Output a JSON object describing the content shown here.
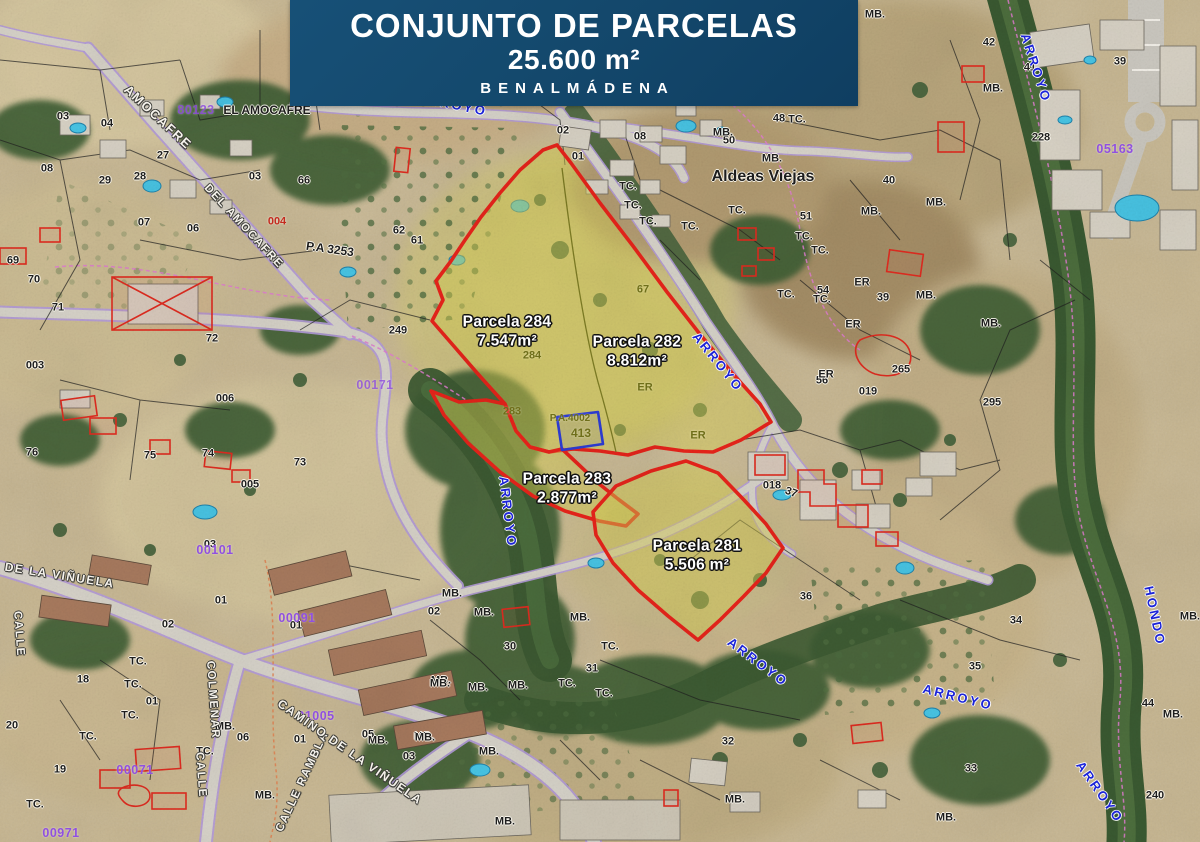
{
  "banner": {
    "title": "CONJUNTO DE PARCELAS",
    "area": "25.600 m²",
    "location": "BENALMÁDENA"
  },
  "colors": {
    "banner_bg": "#14496d",
    "parcel_stroke": "#e8231a",
    "parcel_fill": "rgba(214,204,84,0.48)",
    "blue_plot": "#2d3cd6",
    "stream_text": "#1b23d8",
    "cadastral_purple": "#9050e0",
    "road_purple": "#b49bdc",
    "water_pool": "#48c6e6",
    "vegetation_dark": "#3c5a32"
  },
  "map": {
    "parcels": [
      {
        "number": "284",
        "name": "Parcela 284",
        "area": "7.547m²",
        "label_x": 507,
        "label_y": 332
      },
      {
        "number": "282",
        "name": "Parcela 282",
        "area": "8.812m²",
        "label_x": 637,
        "label_y": 352
      },
      {
        "number": "283",
        "name": "Parcela 283",
        "area": "2.877m²",
        "label_x": 567,
        "label_y": 489
      },
      {
        "number": "281",
        "name": "Parcela 281",
        "area": "5.506 m²",
        "label_x": 697,
        "label_y": 556
      }
    ],
    "parcel_outlines": [
      {
        "id": "parcela-284-282",
        "points": "543,150 557,145 571,163 600,203 633,246 667,292 699,333 733,374 760,404 771,422 741,440 713,452 684,451 655,447 628,455 600,451 573,449 549,452 530,447 516,431 505,404 478,374 452,344 432,321 443,300 436,281 451,261 465,240 481,217 500,193 520,170"
      },
      {
        "id": "parcela-283",
        "points": "431,391 459,402 486,400 505,404 516,431 530,447 549,452 562,449 578,464 598,483 618,499 638,514 626,526 599,521 565,511 533,496 500,472 468,443 444,415"
      },
      {
        "id": "parcela-281",
        "points": "616,486 651,471 686,461 718,473 744,500 766,524 783,548 766,573 744,596 720,620 698,640 668,616 638,590 613,563 596,535 593,512"
      }
    ],
    "parcel_dividers": [
      "M562,168 C572,250 584,330 598,382 C606,410 612,434 616,452"
    ],
    "blue_plot": {
      "points": "557,417 598,412 603,444 562,450"
    },
    "labels": {
      "black": [
        {
          "t": "03",
          "x": 63,
          "y": 117
        },
        {
          "t": "04",
          "x": 107,
          "y": 124
        },
        {
          "t": "08",
          "x": 47,
          "y": 169
        },
        {
          "t": "27",
          "x": 163,
          "y": 156
        },
        {
          "t": "28",
          "x": 140,
          "y": 177
        },
        {
          "t": "29",
          "x": 105,
          "y": 181
        },
        {
          "t": "03",
          "x": 255,
          "y": 177
        },
        {
          "t": "66",
          "x": 304,
          "y": 181
        },
        {
          "t": "07",
          "x": 144,
          "y": 223
        },
        {
          "t": "06",
          "x": 193,
          "y": 229
        },
        {
          "t": "69",
          "x": 13,
          "y": 261
        },
        {
          "t": "70",
          "x": 34,
          "y": 280
        },
        {
          "t": "71",
          "x": 58,
          "y": 308
        },
        {
          "t": "72",
          "x": 212,
          "y": 339
        },
        {
          "t": "003",
          "x": 35,
          "y": 366
        },
        {
          "t": "006",
          "x": 225,
          "y": 399
        },
        {
          "t": "76",
          "x": 32,
          "y": 453
        },
        {
          "t": "75",
          "x": 150,
          "y": 456
        },
        {
          "t": "74",
          "x": 208,
          "y": 454
        },
        {
          "t": "73",
          "x": 300,
          "y": 463
        },
        {
          "t": "005",
          "x": 250,
          "y": 485
        },
        {
          "t": "249",
          "x": 398,
          "y": 331
        },
        {
          "t": "P.A 3253",
          "x": 330,
          "y": 249,
          "r": 8,
          "s": 12
        },
        {
          "t": "EL AMOCAFRE",
          "x": 267,
          "y": 110,
          "s": 12
        },
        {
          "t": "62",
          "x": 399,
          "y": 231
        },
        {
          "t": "61",
          "x": 417,
          "y": 241
        },
        {
          "t": "02",
          "x": 563,
          "y": 131
        },
        {
          "t": "01",
          "x": 578,
          "y": 157
        },
        {
          "t": "08",
          "x": 640,
          "y": 137
        },
        {
          "t": "48",
          "x": 779,
          "y": 119
        },
        {
          "t": "50",
          "x": 729,
          "y": 141
        },
        {
          "t": "40",
          "x": 889,
          "y": 181
        },
        {
          "t": "51",
          "x": 806,
          "y": 217
        },
        {
          "t": "Aldeas Viejas",
          "x": 763,
          "y": 177,
          "s": 16
        },
        {
          "t": "54",
          "x": 823,
          "y": 291
        },
        {
          "t": "39",
          "x": 883,
          "y": 298
        },
        {
          "t": "56",
          "x": 822,
          "y": 381
        },
        {
          "t": "295",
          "x": 992,
          "y": 403
        },
        {
          "t": "265",
          "x": 901,
          "y": 370
        },
        {
          "t": "019",
          "x": 868,
          "y": 392
        },
        {
          "t": "018",
          "x": 772,
          "y": 486
        },
        {
          "t": "37",
          "x": 791,
          "y": 493,
          "r": 20
        },
        {
          "t": "36",
          "x": 806,
          "y": 597
        },
        {
          "t": "42",
          "x": 989,
          "y": 43
        },
        {
          "t": "41",
          "x": 1030,
          "y": 68
        },
        {
          "t": "39",
          "x": 1120,
          "y": 62
        },
        {
          "t": "228",
          "x": 1041,
          "y": 138
        },
        {
          "t": "34",
          "x": 1016,
          "y": 621
        },
        {
          "t": "35",
          "x": 975,
          "y": 667
        },
        {
          "t": "33",
          "x": 971,
          "y": 769
        },
        {
          "t": "44",
          "x": 1148,
          "y": 704
        },
        {
          "t": "240",
          "x": 1155,
          "y": 796
        },
        {
          "t": "30",
          "x": 510,
          "y": 647
        },
        {
          "t": "31",
          "x": 592,
          "y": 669
        },
        {
          "t": "02",
          "x": 434,
          "y": 612
        },
        {
          "t": "03",
          "x": 409,
          "y": 757
        },
        {
          "t": "32",
          "x": 728,
          "y": 742
        },
        {
          "t": "03",
          "x": 210,
          "y": 545
        },
        {
          "t": "01",
          "x": 221,
          "y": 601
        },
        {
          "t": "02",
          "x": 168,
          "y": 625
        },
        {
          "t": "01",
          "x": 296,
          "y": 626
        },
        {
          "t": "18",
          "x": 83,
          "y": 680
        },
        {
          "t": "20",
          "x": 12,
          "y": 726
        },
        {
          "t": "19",
          "x": 60,
          "y": 770
        },
        {
          "t": "01",
          "x": 152,
          "y": 702
        },
        {
          "t": "05",
          "x": 368,
          "y": 735
        },
        {
          "t": "06",
          "x": 243,
          "y": 738
        },
        {
          "t": "01",
          "x": 300,
          "y": 740
        },
        {
          "t": "MB.",
          "x": 723,
          "y": 133
        },
        {
          "t": "MB.",
          "x": 772,
          "y": 159
        },
        {
          "t": "MB.",
          "x": 871,
          "y": 212
        },
        {
          "t": "MB.",
          "x": 936,
          "y": 203
        },
        {
          "t": "MB.",
          "x": 926,
          "y": 296
        },
        {
          "t": "MB.",
          "x": 991,
          "y": 324
        },
        {
          "t": "MB.",
          "x": 993,
          "y": 89
        },
        {
          "t": "MB.",
          "x": 875,
          "y": 15
        },
        {
          "t": "MB.",
          "x": 758,
          "y": 12
        },
        {
          "t": "MB.",
          "x": 1190,
          "y": 617
        },
        {
          "t": "MB.",
          "x": 1173,
          "y": 715
        },
        {
          "t": "MB.",
          "x": 946,
          "y": 818
        },
        {
          "t": "MB.",
          "x": 452,
          "y": 594
        },
        {
          "t": "MB.",
          "x": 484,
          "y": 613
        },
        {
          "t": "MB.",
          "x": 580,
          "y": 618
        },
        {
          "t": "MB.",
          "x": 441,
          "y": 681
        },
        {
          "t": "MB.",
          "x": 478,
          "y": 688
        },
        {
          "t": "MB.",
          "x": 518,
          "y": 686
        },
        {
          "t": "MB.",
          "x": 424,
          "y": 737
        },
        {
          "t": "MB.",
          "x": 489,
          "y": 752
        },
        {
          "t": "MB.",
          "x": 505,
          "y": 822
        },
        {
          "t": "MB.",
          "x": 225,
          "y": 727
        },
        {
          "t": "MB.",
          "x": 378,
          "y": 741
        },
        {
          "t": "MB.",
          "x": 425,
          "y": 738
        },
        {
          "t": "MB.",
          "x": 440,
          "y": 684
        },
        {
          "t": "MB.",
          "x": 265,
          "y": 796
        },
        {
          "t": "MB.",
          "x": 735,
          "y": 800
        },
        {
          "t": "TC.",
          "x": 797,
          "y": 120
        },
        {
          "t": "TC.",
          "x": 737,
          "y": 211
        },
        {
          "t": "TC.",
          "x": 628,
          "y": 187
        },
        {
          "t": "TC.",
          "x": 633,
          "y": 206
        },
        {
          "t": "TC.",
          "x": 648,
          "y": 222
        },
        {
          "t": "TC.",
          "x": 690,
          "y": 227
        },
        {
          "t": "TC.",
          "x": 804,
          "y": 237
        },
        {
          "t": "TC.",
          "x": 820,
          "y": 251
        },
        {
          "t": "TC.",
          "x": 786,
          "y": 295
        },
        {
          "t": "TC.",
          "x": 822,
          "y": 300
        },
        {
          "t": "TC.",
          "x": 610,
          "y": 647
        },
        {
          "t": "TC.",
          "x": 567,
          "y": 684
        },
        {
          "t": "TC.",
          "x": 604,
          "y": 694
        },
        {
          "t": "TC.",
          "x": 138,
          "y": 662
        },
        {
          "t": "TC.",
          "x": 133,
          "y": 685
        },
        {
          "t": "TC.",
          "x": 130,
          "y": 716
        },
        {
          "t": "TC.",
          "x": 35,
          "y": 805
        },
        {
          "t": "TC.",
          "x": 88,
          "y": 737
        },
        {
          "t": "TC.",
          "x": 205,
          "y": 752
        },
        {
          "t": "ER",
          "x": 862,
          "y": 283
        },
        {
          "t": "ER",
          "x": 853,
          "y": 325
        },
        {
          "t": "ER",
          "x": 826,
          "y": 375
        }
      ],
      "red": [
        {
          "t": "004",
          "x": 277,
          "y": 222
        }
      ],
      "olive": [
        {
          "t": "284",
          "x": 532,
          "y": 356
        },
        {
          "t": "283",
          "x": 512,
          "y": 412
        },
        {
          "t": "413",
          "x": 581,
          "y": 433,
          "s": 12
        },
        {
          "t": "P.A.4002",
          "x": 570,
          "y": 419,
          "s": 10
        },
        {
          "t": "67",
          "x": 643,
          "y": 290
        },
        {
          "t": "ER",
          "x": 645,
          "y": 388
        },
        {
          "t": "ER",
          "x": 698,
          "y": 436
        }
      ],
      "purple": [
        {
          "t": "80123",
          "x": 196,
          "y": 110,
          "o": 0.85
        },
        {
          "t": "00101",
          "x": 215,
          "y": 550
        },
        {
          "t": "00091",
          "x": 297,
          "y": 618
        },
        {
          "t": "00071",
          "x": 135,
          "y": 770
        },
        {
          "t": "01005",
          "x": 316,
          "y": 716
        },
        {
          "t": "05163",
          "x": 1115,
          "y": 149
        },
        {
          "t": "00971",
          "x": 61,
          "y": 833
        },
        {
          "t": "00171",
          "x": 375,
          "y": 385,
          "o": 0.8
        }
      ],
      "blue": [
        {
          "t": "ARROYO",
          "x": 718,
          "y": 362,
          "r": 51
        },
        {
          "t": "ARROYO",
          "x": 508,
          "y": 512,
          "r": 83
        },
        {
          "t": "ARROYO",
          "x": 758,
          "y": 662,
          "r": 37
        },
        {
          "t": "ARROYO",
          "x": 958,
          "y": 697,
          "r": 14
        },
        {
          "t": "ARROYO",
          "x": 1036,
          "y": 68,
          "r": 72
        },
        {
          "t": "HONDO",
          "x": 1155,
          "y": 616,
          "r": 78
        },
        {
          "t": "ARROYO",
          "x": 1100,
          "y": 792,
          "r": 55
        },
        {
          "t": "ARROYO",
          "x": 452,
          "y": 104,
          "r": 12
        }
      ],
      "white": [
        {
          "t": "AMOCAFRE",
          "x": 158,
          "y": 117,
          "r": 43,
          "s": 13
        },
        {
          "t": "DEL AMOCAFRE",
          "x": 243,
          "y": 227,
          "r": 47
        },
        {
          "t": "O DE LA VIÑUELA",
          "x": 52,
          "y": 574,
          "r": 9,
          "s": 12
        },
        {
          "t": "CALLE",
          "x": 18,
          "y": 634,
          "r": 86
        },
        {
          "t": "COLMENAR",
          "x": 212,
          "y": 700,
          "r": 86
        },
        {
          "t": "CALLE",
          "x": 200,
          "y": 775,
          "r": 86
        },
        {
          "t": "CALLE  RAMBLA",
          "x": 303,
          "y": 782,
          "r": -65
        },
        {
          "t": "CAMINO DE LA VIÑUELA",
          "x": 350,
          "y": 752,
          "r": 35,
          "s": 12
        }
      ]
    }
  }
}
